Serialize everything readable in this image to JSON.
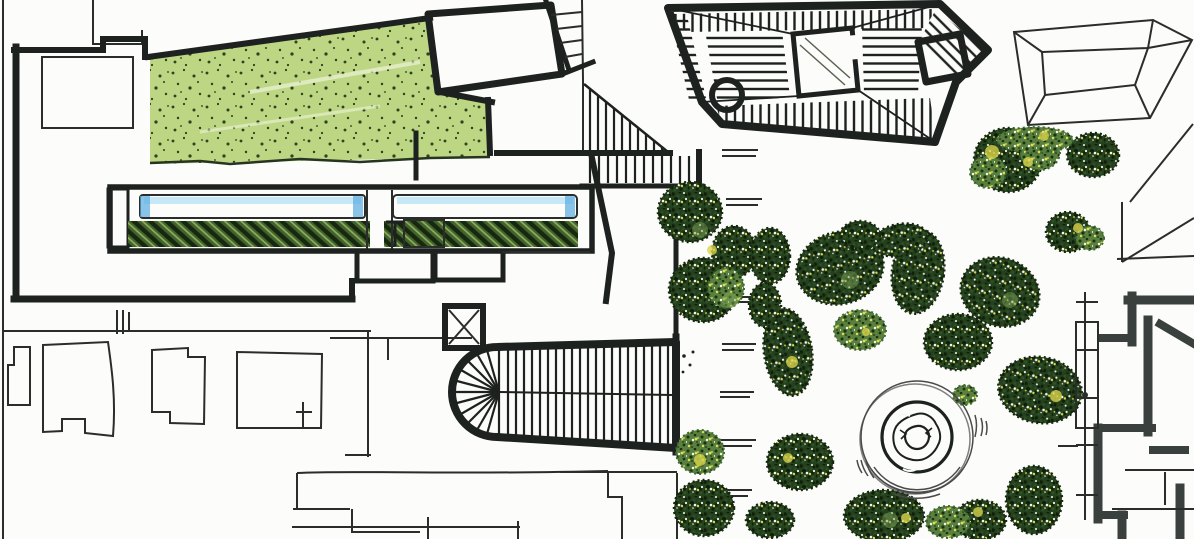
{
  "colors": {
    "paper": "#fcfcfa",
    "ink": "#1d211f",
    "line_thin": "#2b2d2a",
    "wall_gray": "#3a403d",
    "lawn": "#a9cb62",
    "lawn_dot": "#24351a",
    "lawn_streak": "#eef4d8",
    "water": "#7fc6e9",
    "water_light": "#b9e2f5",
    "water_deep": "#58ade0",
    "bed_base": "#44622f",
    "bed_dark": "#16280e",
    "bed_light": "#8fb35a",
    "cap_base": "#33352b",
    "accent_yellow": "#d9d44b",
    "accent_light_green": "#7da457",
    "tree_dark_base": "#24401c",
    "tree_dot_dark": "#0f1f0a",
    "tree_dot_mid": "#2e5226",
    "tree_light_base": "#5a8040",
    "tree_light_dot": "#1c330f",
    "fountain_water": "#7cc4e6",
    "fountain_center": "#48a8dc",
    "sketch_gray": "#4a4a4a",
    "courtyard_dark": "#20241f"
  },
  "features": [
    "lawn-terrace",
    "reflecting-pool-west",
    "reflecting-pool-east",
    "planting-bed-west",
    "planting-bed-east",
    "grand-staircase",
    "ramp-ladder-stair",
    "pergola-colonnade",
    "pavilion-tower",
    "villa-hatched-roof",
    "courtyard-void",
    "corner-turret",
    "hip-roof-building",
    "garden-square",
    "central-fountain",
    "street-grid",
    "avenue-dashed-centerline",
    "castle-wall-building",
    "survey-line",
    "tree-canopy"
  ]
}
